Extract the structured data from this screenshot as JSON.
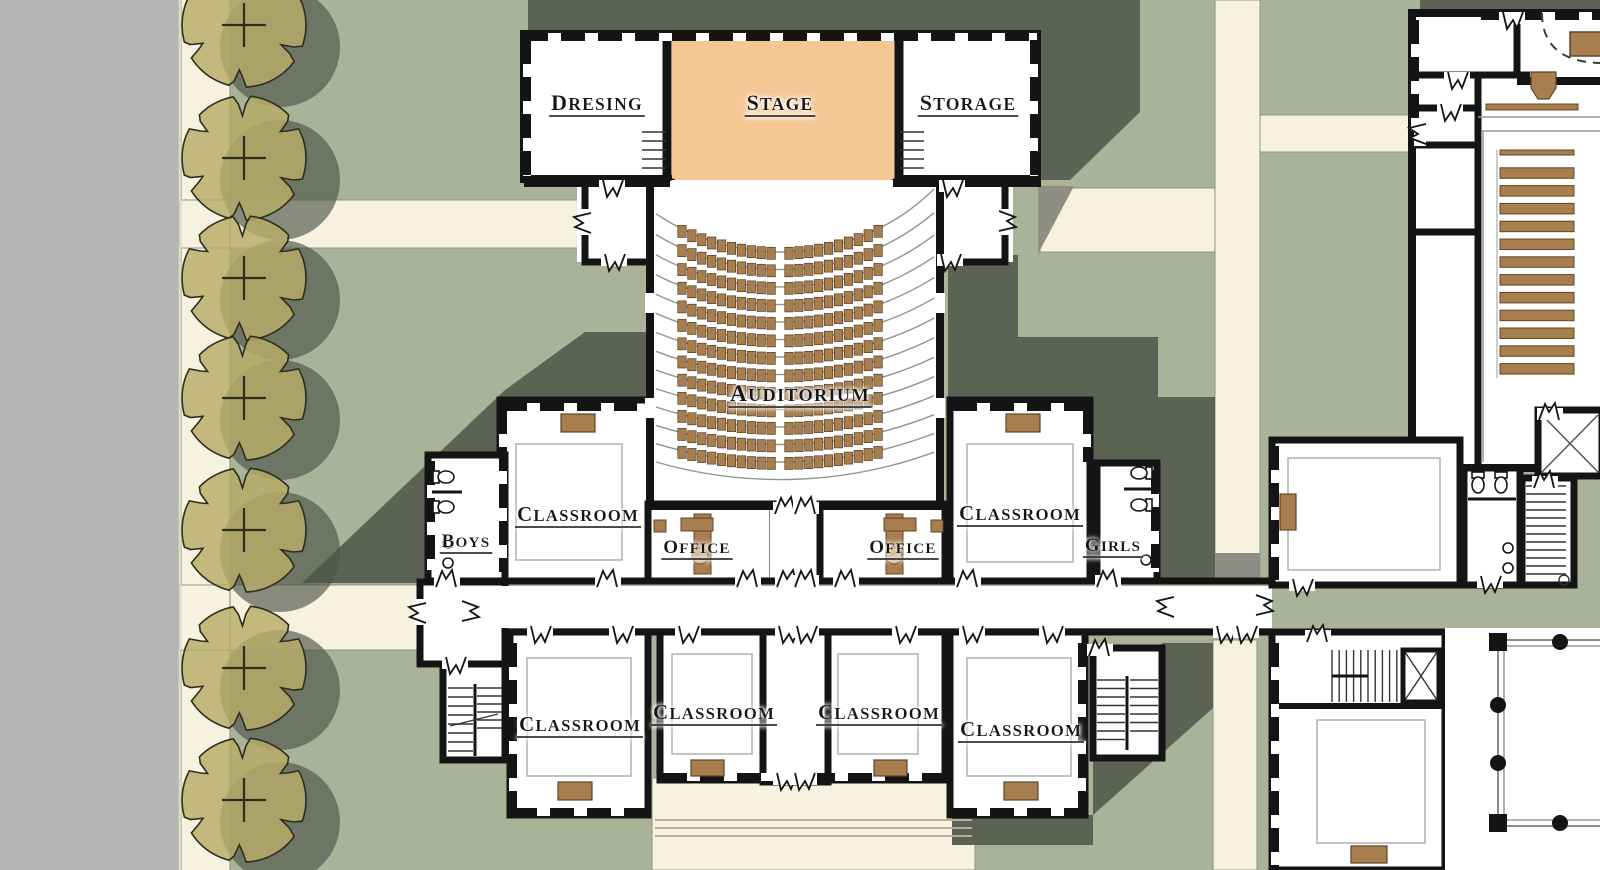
{
  "meta": {
    "drawing_type": "architectural site / floor plan",
    "visible_buildings": [
      "school classroom and auditorium wing",
      "chapel / assembly hall with pews"
    ]
  },
  "colors": {
    "lawn": "#a8b399",
    "road": "#b5b5b4",
    "path_cream": "#f6f2df",
    "shadow_dark": "#5c6354",
    "shadow_on_path": "#8e8e85",
    "wall_black": "#141414",
    "stage_orange": "#f5c795",
    "furniture_brown": "#a87e4e",
    "tree_khaki": "#b7ac66"
  },
  "labels": [
    {
      "id": "dresing",
      "text": "DRESING",
      "x": 597,
      "y": 110,
      "size": 22
    },
    {
      "id": "stage",
      "text": "STAGE",
      "x": 780,
      "y": 110,
      "size": 22
    },
    {
      "id": "storage",
      "text": "STORAGE",
      "x": 968,
      "y": 110,
      "size": 22
    },
    {
      "id": "auditorium",
      "text": "AUDITORIUM",
      "x": 800,
      "y": 401,
      "size": 23
    },
    {
      "id": "classroom-upper-left",
      "text": "CLASSROOM",
      "x": 578,
      "y": 521,
      "size": 21
    },
    {
      "id": "boys",
      "text": "BOYS",
      "x": 466,
      "y": 547,
      "size": 19
    },
    {
      "id": "office-left",
      "text": "OFFICE",
      "x": 697,
      "y": 553,
      "size": 19
    },
    {
      "id": "office-right",
      "text": "OFFICE",
      "x": 903,
      "y": 553,
      "size": 19
    },
    {
      "id": "classroom-upper-right",
      "text": "CLASSROOM",
      "x": 1020,
      "y": 520,
      "size": 21
    },
    {
      "id": "girls",
      "text": "GIRLS",
      "x": 1113,
      "y": 551,
      "size": 19
    },
    {
      "id": "classroom-bottom-1",
      "text": "CLASSROOM",
      "x": 580,
      "y": 731,
      "size": 21
    },
    {
      "id": "classroom-bottom-2",
      "text": "CLASSROOM",
      "x": 714,
      "y": 719,
      "size": 21
    },
    {
      "id": "classroom-bottom-3",
      "text": "CLASSROOM",
      "x": 879,
      "y": 719,
      "size": 21
    },
    {
      "id": "classroom-bottom-4",
      "text": "CLASSROOM",
      "x": 1021,
      "y": 736,
      "size": 21
    }
  ],
  "auditorium": {
    "seat_rows": 13,
    "seats_per_row_side": 10,
    "seat_blocks": 2,
    "row_guide_lines": 14
  },
  "chapel": {
    "pew_count": 13,
    "has_podium": true,
    "has_altar_rail": true,
    "has_dashed_chancel_platform": true
  },
  "trees": {
    "count": 7,
    "centers_y": [
      25,
      158,
      278,
      398,
      530,
      668,
      800
    ],
    "center_x": 244,
    "radius": 62
  }
}
